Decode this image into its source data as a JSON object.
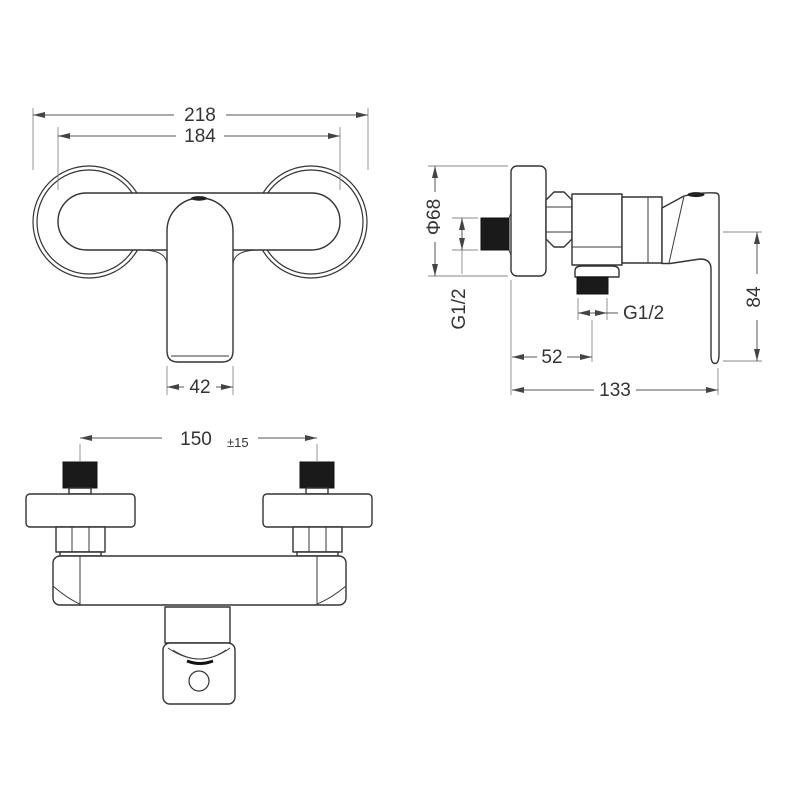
{
  "drawing_type": "shower-mixer-technical-drawing",
  "colors": {
    "background": "#ffffff",
    "line": "#333333",
    "dimension": "#555555",
    "thread_fill": "#1a1a1a"
  },
  "front_view": {
    "overall_width": "218",
    "body_width": "184",
    "handle_width": "42"
  },
  "side_view": {
    "escutcheon_diameter": "Φ68",
    "inlet_thread": "G1/2",
    "outlet_thread": "G1/2",
    "wall_to_outlet_center": "52",
    "total_depth": "133",
    "handle_length": "84"
  },
  "bottom_view": {
    "inlet_spacing": "150",
    "inlet_spacing_tolerance": "±15"
  }
}
